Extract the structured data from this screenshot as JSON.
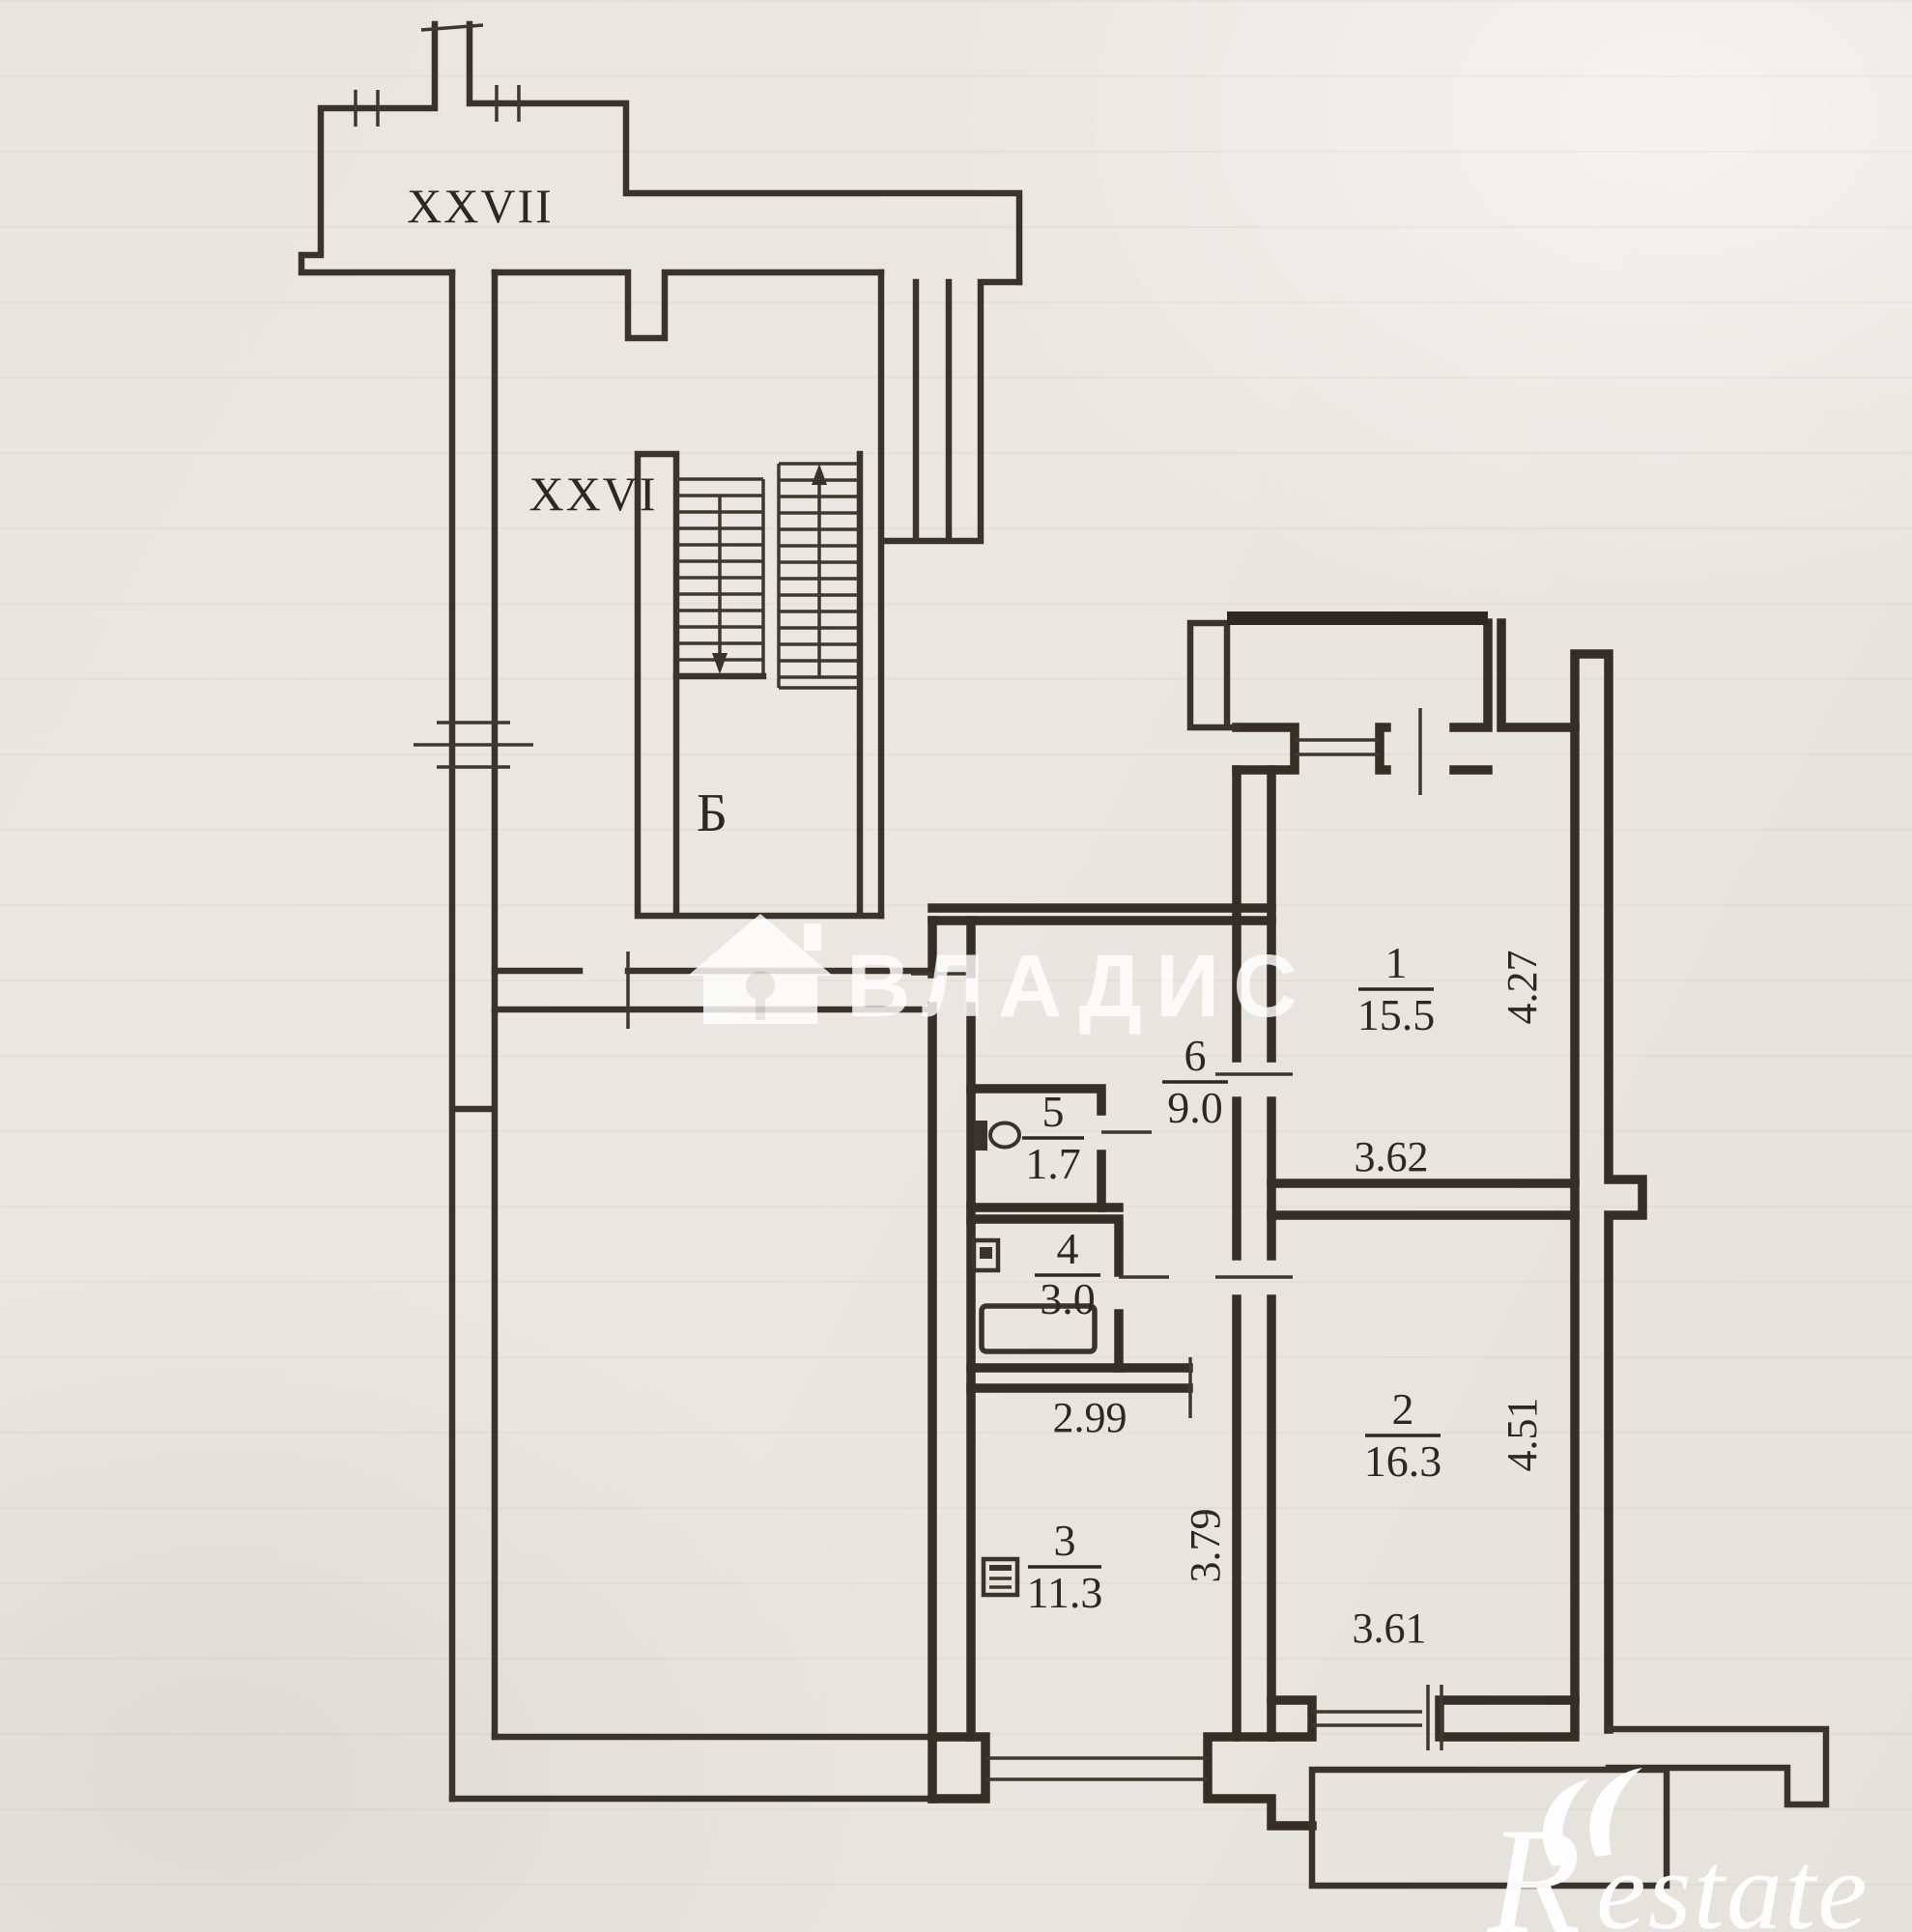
{
  "labels": {
    "corridor_upper": "XXVII",
    "corridor_lower": "XXVI",
    "staircase": "Б"
  },
  "rooms": [
    {
      "number": "1",
      "area": "15.5"
    },
    {
      "number": "2",
      "area": "16.3"
    },
    {
      "number": "3",
      "area": "11.3"
    },
    {
      "number": "4",
      "area": "3.0"
    },
    {
      "number": "5",
      "area": "1.7"
    },
    {
      "number": "6",
      "area": "9.0"
    }
  ],
  "dimensions": {
    "room1_w": "3.62",
    "room1_h": "4.27",
    "room2_w": "3.61",
    "room2_h": "4.51",
    "kitchen_w": "2.99",
    "kitchen_h": "3.79"
  },
  "watermark": {
    "brand": "ВЛАДИС",
    "logo_r": "R",
    "logo_rest": "estate"
  },
  "colors": {
    "wall": "#3a332b",
    "paper": "#e9e6e1",
    "watermark": "#ffffff"
  }
}
